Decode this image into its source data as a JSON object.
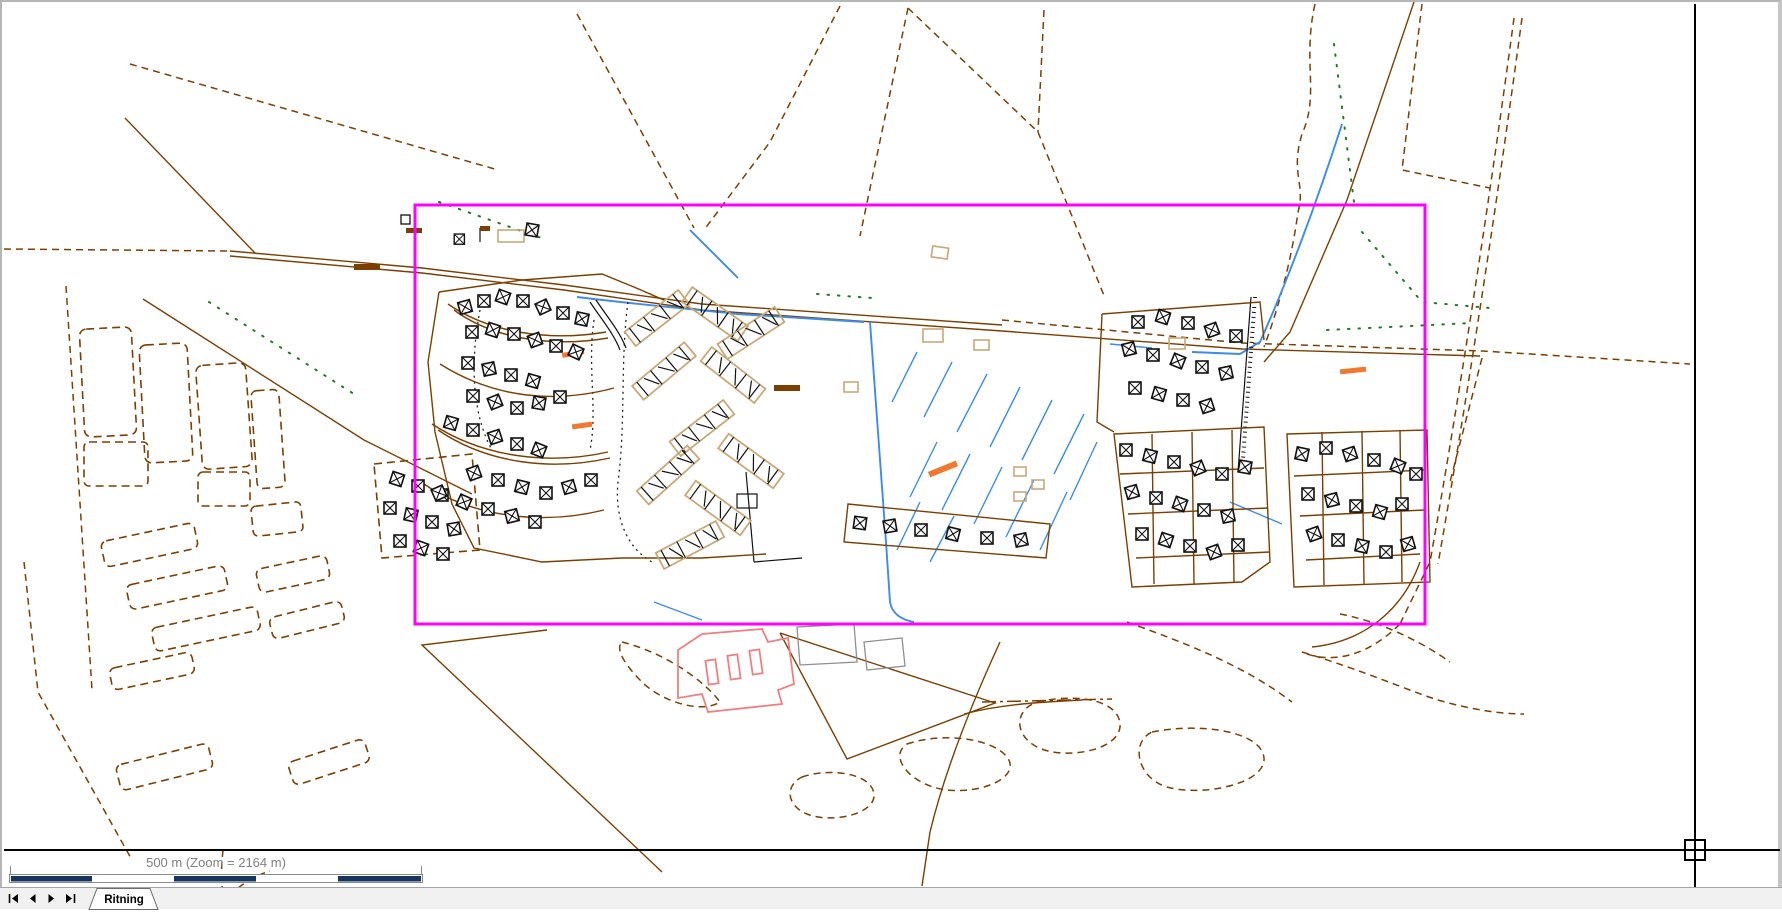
{
  "statusbar": {
    "scale_label": "500 m (Zoom = 2164 m)",
    "scale_total": "500 m",
    "zoom_value": "2164 m",
    "scalebar_segments": 5
  },
  "sheet_navigation": {
    "buttons": [
      {
        "name": "first-sheet"
      },
      {
        "name": "previous-sheet"
      },
      {
        "name": "next-sheet"
      },
      {
        "name": "last-sheet"
      }
    ]
  },
  "tabs": [
    {
      "label": "Ritning",
      "active": true
    }
  ],
  "map": {
    "selection_rectangle": {
      "x": 413,
      "y": 203,
      "width": 1010,
      "height": 419
    },
    "layers": [
      "parcel-boundaries-dashed-brown",
      "field-strips-dashed-brown",
      "roads-solid-brown",
      "watercourses-blue",
      "vegetation-dots-green",
      "residential-buildings-x-symbols",
      "apartment-blocks-hatched",
      "highlighted-building-red",
      "accent-markings-orange",
      "print-page-boundary"
    ]
  },
  "colors": {
    "brown": "#7B3F00",
    "blue": "#3C8CEC",
    "green": "#1E7A1E",
    "magenta": "#FF00FF",
    "red": "#F08080",
    "orange": "#F07830",
    "tan": "#C9A878",
    "navy": "#16365F",
    "graytext": "#808080",
    "border": "#b6b6b6",
    "tabbar": "#f1f1f1"
  }
}
